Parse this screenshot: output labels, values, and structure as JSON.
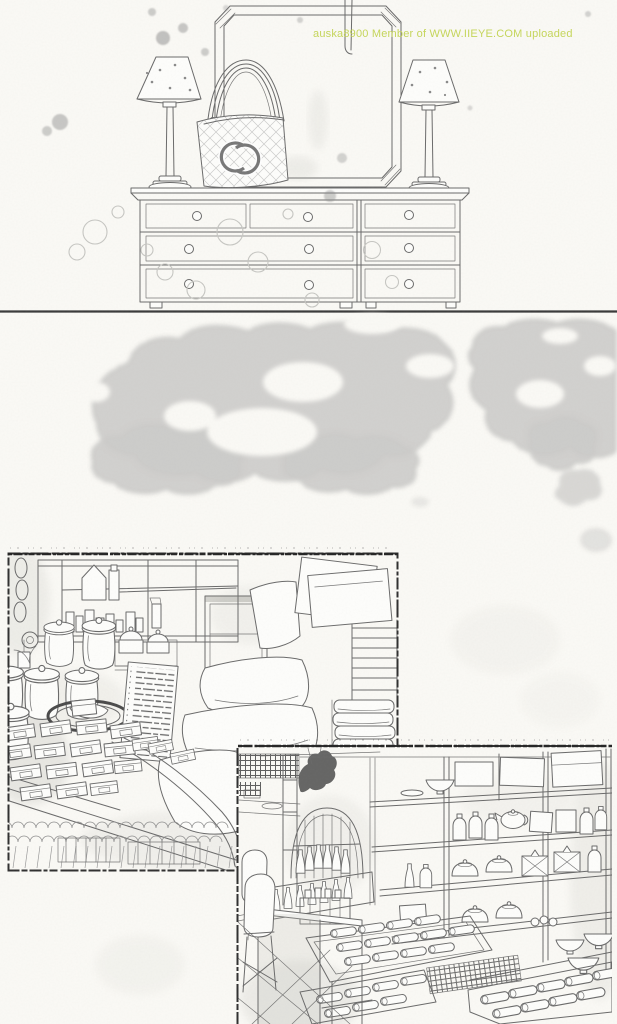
{
  "page": {
    "kind": "scanned-manga-page",
    "watermark": {
      "text": "auska8900 Member of WWW.IIEYE.COM uploaded"
    },
    "colors": {
      "paper": "#fbfaf6",
      "ink": "#6a6a6a",
      "dark_ink": "#3a3a3a",
      "tone": "#9c9c9c",
      "watermark_green": "#c0d24e"
    },
    "panels": {
      "dresser": "dresser vignette with mirror, two lamps and quilted CC tote bag",
      "sky": "sky panel with halftone clouds",
      "shop_left": "shop interior with glass jars, price sign, stacked goods and towels",
      "shop_right": "shop interior with pottery shelves, bottle display and goods trays"
    }
  }
}
